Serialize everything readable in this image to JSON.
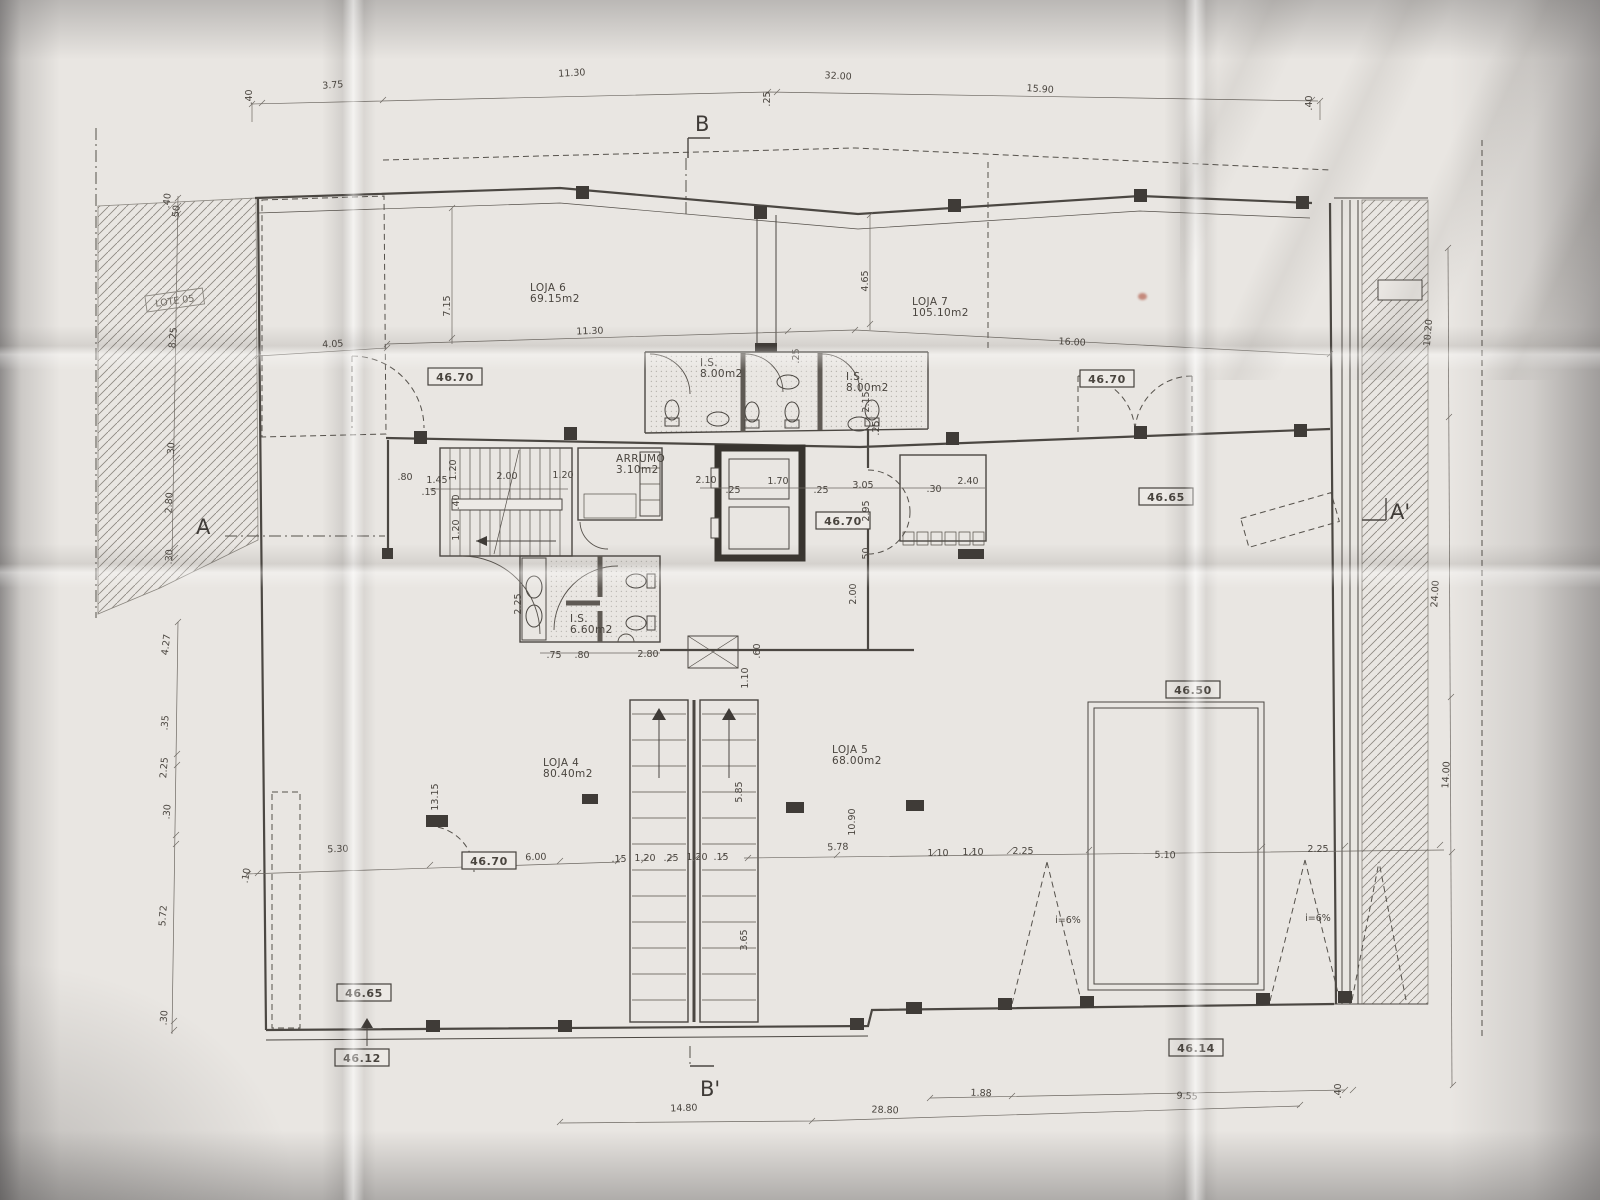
{
  "photo": {
    "description": "Photographed architectural ground-floor plan on folded paper",
    "paper_color": "#e9e6e2",
    "ink_color": "#4b4742"
  },
  "section_markers": {
    "top": "B",
    "bottom": "B'",
    "left": "A",
    "right": "A'"
  },
  "site_label": "LOTE 05",
  "rooms": [
    {
      "name": "LOJA 6",
      "area": "69.15m2",
      "x": 530,
      "y": 291
    },
    {
      "name": "LOJA 7",
      "area": "105.10m2",
      "x": 912,
      "y": 305
    },
    {
      "name": "I.S.",
      "area": "8.00m2",
      "x": 700,
      "y": 366
    },
    {
      "name": "I.S.",
      "area": "8.00m2",
      "x": 846,
      "y": 380
    },
    {
      "name": "ARRUMO",
      "area": "3.10m2",
      "x": 616,
      "y": 462
    },
    {
      "name": "I.S.",
      "area": "6.60m2",
      "x": 570,
      "y": 622
    },
    {
      "name": "LOJA 4",
      "area": "80.40m2",
      "x": 543,
      "y": 766
    },
    {
      "name": "LOJA 5",
      "area": "68.00m2",
      "x": 832,
      "y": 753
    }
  ],
  "levels": [
    {
      "value": "46.70",
      "x": 455,
      "y": 377
    },
    {
      "value": "46.70",
      "x": 1107,
      "y": 379
    },
    {
      "value": "46.65",
      "x": 1166,
      "y": 497
    },
    {
      "value": "46.70",
      "x": 843,
      "y": 521
    },
    {
      "value": "46.70",
      "x": 489,
      "y": 861
    },
    {
      "value": "46.50",
      "x": 1193,
      "y": 690
    },
    {
      "value": "46.65",
      "x": 364,
      "y": 993
    },
    {
      "value": "46.12",
      "x": 362,
      "y": 1058
    },
    {
      "value": "46.14",
      "x": 1196,
      "y": 1048
    }
  ],
  "dimensions": [
    {
      "t": ".40",
      "x": 252,
      "y": 97,
      "r": -90
    },
    {
      "t": "3.75",
      "x": 333,
      "y": 88,
      "r": -4
    },
    {
      "t": "11.30",
      "x": 572,
      "y": 76,
      "r": -3
    },
    {
      "t": "32.00",
      "x": 838,
      "y": 79,
      "r": 3
    },
    {
      "t": ".25",
      "x": 770,
      "y": 99,
      "r": -90
    },
    {
      "t": "15.90",
      "x": 1040,
      "y": 92,
      "r": 4
    },
    {
      "t": ".40",
      "x": 1312,
      "y": 103,
      "r": -90
    },
    {
      "t": ".40",
      "x": 170,
      "y": 201,
      "r": -83
    },
    {
      "t": ".50",
      "x": 179,
      "y": 213,
      "r": -83
    },
    {
      "t": "8.25",
      "x": 176,
      "y": 338,
      "r": -85
    },
    {
      "t": ".30",
      "x": 174,
      "y": 450,
      "r": -87
    },
    {
      "t": "2.80",
      "x": 172,
      "y": 503,
      "r": -87
    },
    {
      "t": ".30",
      "x": 172,
      "y": 557,
      "r": -87
    },
    {
      "t": "4.27",
      "x": 169,
      "y": 645,
      "r": -83
    },
    {
      "t": ".35",
      "x": 168,
      "y": 723,
      "r": -85
    },
    {
      "t": "2.25",
      "x": 167,
      "y": 768,
      "r": -85
    },
    {
      "t": ".30",
      "x": 170,
      "y": 812,
      "r": -85
    },
    {
      "t": "5.72",
      "x": 166,
      "y": 916,
      "r": -86
    },
    {
      "t": ".30",
      "x": 167,
      "y": 1018,
      "r": -86
    },
    {
      "t": "4.05",
      "x": 333,
      "y": 347,
      "r": -3
    },
    {
      "t": "7.15",
      "x": 450,
      "y": 306,
      "r": -90
    },
    {
      "t": "11.30",
      "x": 590,
      "y": 334,
      "r": -2
    },
    {
      "t": "4.65",
      "x": 868,
      "y": 281,
      "r": -90
    },
    {
      "t": "16.00",
      "x": 1072,
      "y": 345,
      "r": 3
    },
    {
      "t": ".25",
      "x": 799,
      "y": 356,
      "r": -90
    },
    {
      "t": "2.15",
      "x": 869,
      "y": 402,
      "r": -90
    },
    {
      "t": ".25",
      "x": 879,
      "y": 428,
      "r": -90
    },
    {
      "t": ".80",
      "x": 405,
      "y": 480,
      "r": 0
    },
    {
      "t": "1.45",
      "x": 437,
      "y": 483,
      "r": 0
    },
    {
      "t": ".15",
      "x": 429,
      "y": 495,
      "r": 0
    },
    {
      "t": "1.20",
      "x": 456,
      "y": 470,
      "r": -90
    },
    {
      "t": "2.00",
      "x": 507,
      "y": 479,
      "r": 0
    },
    {
      "t": "1.20",
      "x": 563,
      "y": 478,
      "r": 0
    },
    {
      "t": ".40",
      "x": 459,
      "y": 502,
      "r": -90
    },
    {
      "t": "1.20",
      "x": 459,
      "y": 530,
      "r": -90
    },
    {
      "t": "2.10",
      "x": 706,
      "y": 483,
      "r": 0
    },
    {
      "t": ".25",
      "x": 733,
      "y": 493,
      "r": 0
    },
    {
      "t": "1.70",
      "x": 778,
      "y": 484,
      "r": 0
    },
    {
      "t": ".25",
      "x": 821,
      "y": 493,
      "r": 0
    },
    {
      "t": "3.05",
      "x": 863,
      "y": 488,
      "r": 0
    },
    {
      "t": ".30",
      "x": 934,
      "y": 492,
      "r": 0
    },
    {
      "t": "2.40",
      "x": 968,
      "y": 484,
      "r": 0
    },
    {
      "t": "2.95",
      "x": 869,
      "y": 511,
      "r": -90
    },
    {
      "t": ".50",
      "x": 869,
      "y": 555,
      "r": -90
    },
    {
      "t": "2.00",
      "x": 856,
      "y": 594,
      "r": -90
    },
    {
      "t": "2.25",
      "x": 521,
      "y": 604,
      "r": -90
    },
    {
      "t": ".75",
      "x": 554,
      "y": 658,
      "r": 0
    },
    {
      "t": ".80",
      "x": 582,
      "y": 658,
      "r": 0
    },
    {
      "t": "2.80",
      "x": 648,
      "y": 657,
      "r": 0
    },
    {
      "t": ".60",
      "x": 760,
      "y": 651,
      "r": -90
    },
    {
      "t": "1.10",
      "x": 748,
      "y": 678,
      "r": -90
    },
    {
      "t": ".10",
      "x": 249,
      "y": 876,
      "r": -80
    },
    {
      "t": "5.30",
      "x": 338,
      "y": 852,
      "r": -2
    },
    {
      "t": "13.15",
      "x": 438,
      "y": 797,
      "r": -90
    },
    {
      "t": "6.00",
      "x": 536,
      "y": 860,
      "r": -2
    },
    {
      "t": ".15",
      "x": 619,
      "y": 862,
      "r": 0
    },
    {
      "t": "1.20",
      "x": 645,
      "y": 861,
      "r": 0
    },
    {
      "t": ".25",
      "x": 671,
      "y": 861,
      "r": 0
    },
    {
      "t": "1.20",
      "x": 697,
      "y": 860,
      "r": 0
    },
    {
      "t": ".15",
      "x": 721,
      "y": 860,
      "r": 0
    },
    {
      "t": "5.85",
      "x": 742,
      "y": 792,
      "r": -90
    },
    {
      "t": "3.65",
      "x": 747,
      "y": 940,
      "r": -90
    },
    {
      "t": "10.90",
      "x": 855,
      "y": 822,
      "r": -90
    },
    {
      "t": "5.78",
      "x": 838,
      "y": 850,
      "r": -2
    },
    {
      "t": "1.10",
      "x": 938,
      "y": 856,
      "r": 0
    },
    {
      "t": "1.10",
      "x": 973,
      "y": 855,
      "r": 0
    },
    {
      "t": "2.25",
      "x": 1023,
      "y": 854,
      "r": 0
    },
    {
      "t": "5.10",
      "x": 1165,
      "y": 858,
      "r": 2
    },
    {
      "t": "2.25",
      "x": 1318,
      "y": 852,
      "r": 0
    },
    {
      "t": "i=6%",
      "x": 1068,
      "y": 923,
      "r": 0
    },
    {
      "t": "i=6%",
      "x": 1318,
      "y": 921,
      "r": 0
    },
    {
      "t": "10.20",
      "x": 1431,
      "y": 333,
      "r": -85
    },
    {
      "t": "24.00",
      "x": 1438,
      "y": 594,
      "r": -87
    },
    {
      "t": "14.00",
      "x": 1449,
      "y": 775,
      "r": -87
    },
    {
      "t": "1.88",
      "x": 981,
      "y": 1096,
      "r": 2
    },
    {
      "t": "9.55",
      "x": 1187,
      "y": 1099,
      "r": 3
    },
    {
      "t": ".40",
      "x": 1341,
      "y": 1091,
      "r": -90
    },
    {
      "t": "14.80",
      "x": 684,
      "y": 1111,
      "r": -2
    },
    {
      "t": "28.80",
      "x": 885,
      "y": 1113,
      "r": 2
    }
  ]
}
